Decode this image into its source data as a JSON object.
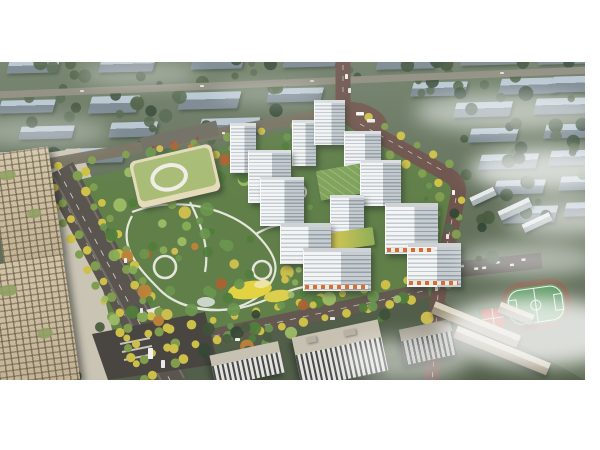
{
  "scene": {
    "type": "aerial-architectural-rendering",
    "setting": "residential masterplan with central park, seen from above at an angle, autumn trees and drifting mist",
    "elements": [
      "background-housing-blocks",
      "residential-tower-cluster",
      "central-park",
      "kindergarten-green-roof",
      "office-towers",
      "tree-lined-boulevard",
      "main-road",
      "south-boulevard",
      "school-campus",
      "football-pitch",
      "basketball-courts",
      "parking-lot",
      "mist-clouds"
    ],
    "counts": {
      "residential_towers": 12,
      "office_towers": 2,
      "background_blocks": 30
    }
  },
  "palette": {
    "canvas": "#ffffff",
    "bgGrass": "#6b7a62",
    "slabTop": "#b9c7d3",
    "slabSide": "#77848e",
    "treeDark": "#3a4d34",
    "parkGreen": "#5d7c44",
    "roadMain": "#6b5048",
    "roadDark": "#56504a",
    "plazaDark": "#443f3a",
    "pathWhite": "#efeee7",
    "towerFace": "#f2f4f5",
    "towerStripe": "#a9b4bb",
    "officeBeige": "#c3b394",
    "schoolRoof": "#a8bc72",
    "schoolCream": "#e7dcba",
    "boulevardYellow": "#cfc143",
    "pitchGreen": "#4f9156",
    "trackBrown": "#7c5a46",
    "courtRed": "#b5402e",
    "slabBeige": "#c9c2b2",
    "playgroundYellow": "#e6d33c",
    "mist": "#ffffff"
  }
}
